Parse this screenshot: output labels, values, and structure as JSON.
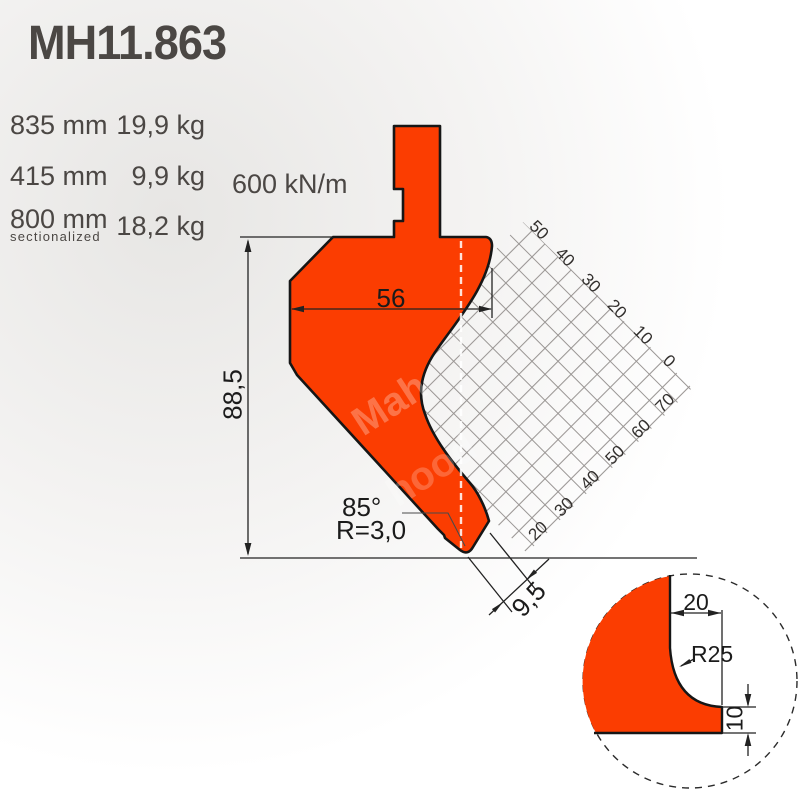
{
  "title": "MH11.863",
  "specs": {
    "rows": [
      {
        "length": "835 mm",
        "weight": "19,9 kg"
      },
      {
        "length": "415 mm",
        "weight": "9,9 kg"
      },
      {
        "length": "800 mm",
        "weight": "18,2 kg",
        "note": "sectionalized"
      }
    ],
    "force": "600 kN/m"
  },
  "drawing": {
    "dims": {
      "body_width": "56",
      "height": "88,5",
      "tip_angle": "85°",
      "tip_radius": "R=3,0",
      "tip_width": "9,5"
    },
    "grid": {
      "top_labels": [
        "50",
        "40",
        "30",
        "20",
        "10",
        "0"
      ],
      "right_labels": [
        "70",
        "60",
        "50",
        "40",
        "30",
        "20"
      ]
    },
    "watermark": {
      "part1": "Mah",
      "part2": "hood"
    }
  },
  "detail": {
    "dims": {
      "shoulder_width": "20",
      "relief_radius": "R25",
      "face_height": "10"
    }
  },
  "colors": {
    "accent": "#fb3d01",
    "outline": "#161616",
    "heading_text": "#4b4744",
    "dim_text": "#1b1b1b",
    "grid_line": "#9a9694"
  }
}
